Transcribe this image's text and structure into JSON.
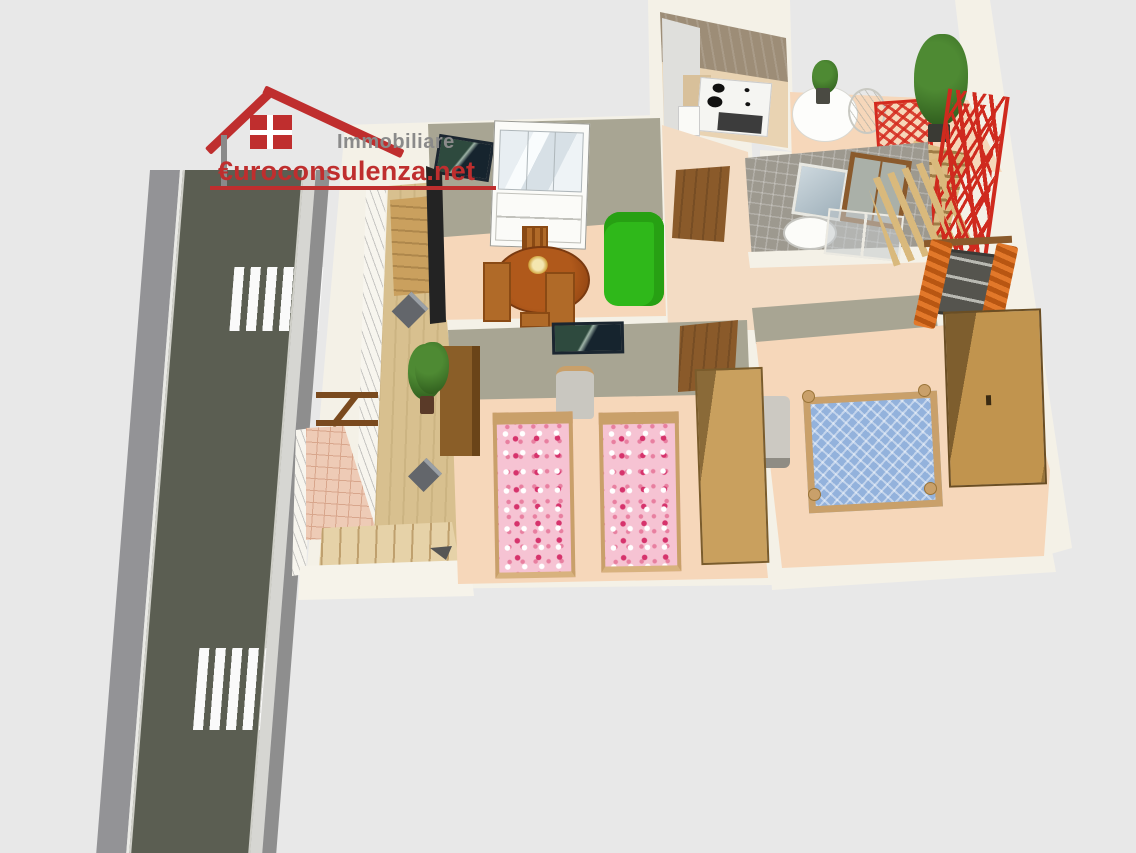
{
  "meta": {
    "kind": "3d-floorplan-render",
    "width_px": 1136,
    "height_px": 853,
    "description": "Bird's-eye 3D rendering of an apartment floor plan with balcony, roof terrace and adjacent street with two zebra crossings"
  },
  "logo": {
    "company_label": "Immobiliare",
    "site_label": "€uroconsulenza.net",
    "icon": "house-icon",
    "company_color": "#8a8a8a",
    "site_color": "#bf2e2e"
  },
  "palette": {
    "background": "#e8e8e8",
    "exterior_wall": "#f4f1e7",
    "interior_wall_olive": "#a8a593",
    "floor_peach": "#f6d7ba",
    "floor_balcony_tan": "#d8c08f",
    "kitchen_back_wall": "#9d8d77",
    "bathroom_tile_gray": "#9d998f",
    "road_asphalt": "#5b5e52",
    "road_sidewalk": "#8e8e8e",
    "road_curb": "#d6d6d2",
    "crosswalk_white": "#fafafa",
    "sofa_green": "#2fb81a",
    "dining_table_brown": "#a8541a",
    "wood_tan": "#c9a05e",
    "bed_floral_pink": "#f6c3d3",
    "bed_blue": "#93b2dc",
    "accent_red": "#d42a1e",
    "curtain_orange": "#d2691e",
    "plant_green": "#3f7d2a",
    "patio_tile_pink": "#eecbb6"
  },
  "scene": {
    "rooms": [
      "kitchen",
      "roof-terrace",
      "living-dining-room",
      "hallway",
      "bathroom",
      "kids-bedroom",
      "master-bedroom",
      "balcony",
      "patio-with-stairs"
    ],
    "exterior": [
      "road",
      "sidewalks",
      "zebra-crossing-upper",
      "zebra-crossing-lower",
      "outdoor-staircase",
      "pergolas"
    ],
    "furniture": {
      "kitchen": [
        "stove-with-oven",
        "refrigerator",
        "cabinets",
        "counter"
      ],
      "roof_terrace": [
        "round-white-table",
        "table-plant",
        "wire-chair",
        "red-folding-chair",
        "potted-tree",
        "red-stair-railing",
        "wooden-steps"
      ],
      "living_dining": [
        "wall-tv",
        "tv-panel",
        "white-display-cabinet",
        "green-sofa",
        "round-dining-table",
        "dining-chairs",
        "flower-centerpiece"
      ],
      "hallway": [
        "wooden-door-upper",
        "wooden-door-lower"
      ],
      "bathroom": [
        "mirror",
        "framed-window",
        "washbasin",
        "shower-enclosure"
      ],
      "kids_bedroom": [
        "wall-tv",
        "chair",
        "single-bed-floral-left",
        "single-bed-floral-right",
        "tall-dresser",
        "wardrobe",
        "potted-plant"
      ],
      "master_bedroom": [
        "double-bed-blue",
        "large-wardrobe",
        "chair",
        "window-with-orange-curtains"
      ],
      "balcony": [
        "planter-upper",
        "planter-lower",
        "potted-plant",
        "wooden-pergola"
      ]
    }
  }
}
